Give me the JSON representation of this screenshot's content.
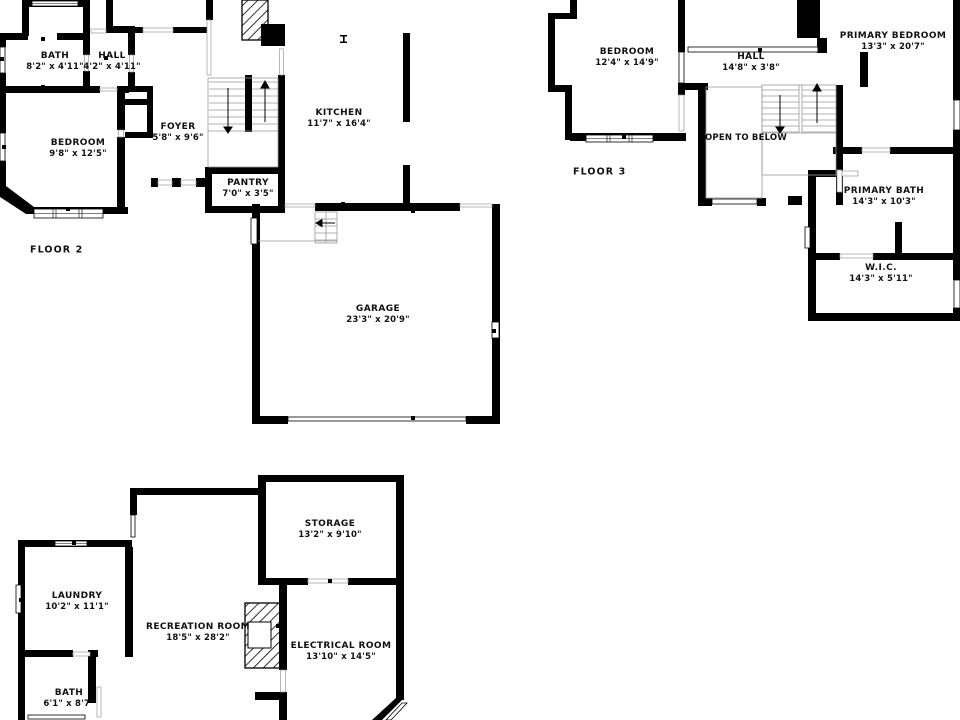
{
  "colors": {
    "wall": "#000000",
    "background": "#ffffff",
    "text": "#111111",
    "stair_line": "#999999"
  },
  "floor2": {
    "label": "FLOOR 2",
    "rooms": {
      "bath": {
        "name": "BATH",
        "dims": "8'2\" x 4'11\""
      },
      "hall": {
        "name": "HALL",
        "dims": "4'2\" x 4'11\""
      },
      "bedroom": {
        "name": "BEDROOM",
        "dims": "9'8\" x 12'5\""
      },
      "foyer": {
        "name": "FOYER",
        "dims": "5'8\" x 9'6\""
      },
      "kitchen": {
        "name": "KITCHEN",
        "dims": "11'7\" x 16'4\""
      },
      "pantry": {
        "name": "PANTRY",
        "dims": "7'0\" x 3'5\""
      },
      "garage": {
        "name": "GARAGE",
        "dims": "23'3\" x 20'9\""
      }
    }
  },
  "floor3": {
    "label": "FLOOR 3",
    "rooms": {
      "bedroom": {
        "name": "BEDROOM",
        "dims": "12'4\" x 14'9\""
      },
      "hall": {
        "name": "HALL",
        "dims": "14'8\" x 3'8\""
      },
      "primary_bedroom": {
        "name": "PRIMARY BEDROOM",
        "dims": "13'3\" x 20'7\""
      },
      "open_to_below": {
        "name": "OPEN TO BELOW"
      },
      "primary_bath": {
        "name": "PRIMARY BATH",
        "dims": "14'3\" x 10'3\""
      },
      "wic": {
        "name": "W.I.C.",
        "dims": "14'3\" x 5'11\""
      }
    }
  },
  "floor1": {
    "rooms": {
      "laundry": {
        "name": "LAUNDRY",
        "dims": "10'2\" x 11'1\""
      },
      "storage": {
        "name": "STORAGE",
        "dims": "13'2\" x 9'10\""
      },
      "recreation_room": {
        "name": "RECREATION ROOM",
        "dims": "18'5\" x 28'2\""
      },
      "electrical_room": {
        "name": "ELECTRICAL ROOM",
        "dims": "13'10\" x 14'5\""
      },
      "bath": {
        "name": "BATH",
        "dims": "6'1\" x 8'7\""
      }
    }
  }
}
